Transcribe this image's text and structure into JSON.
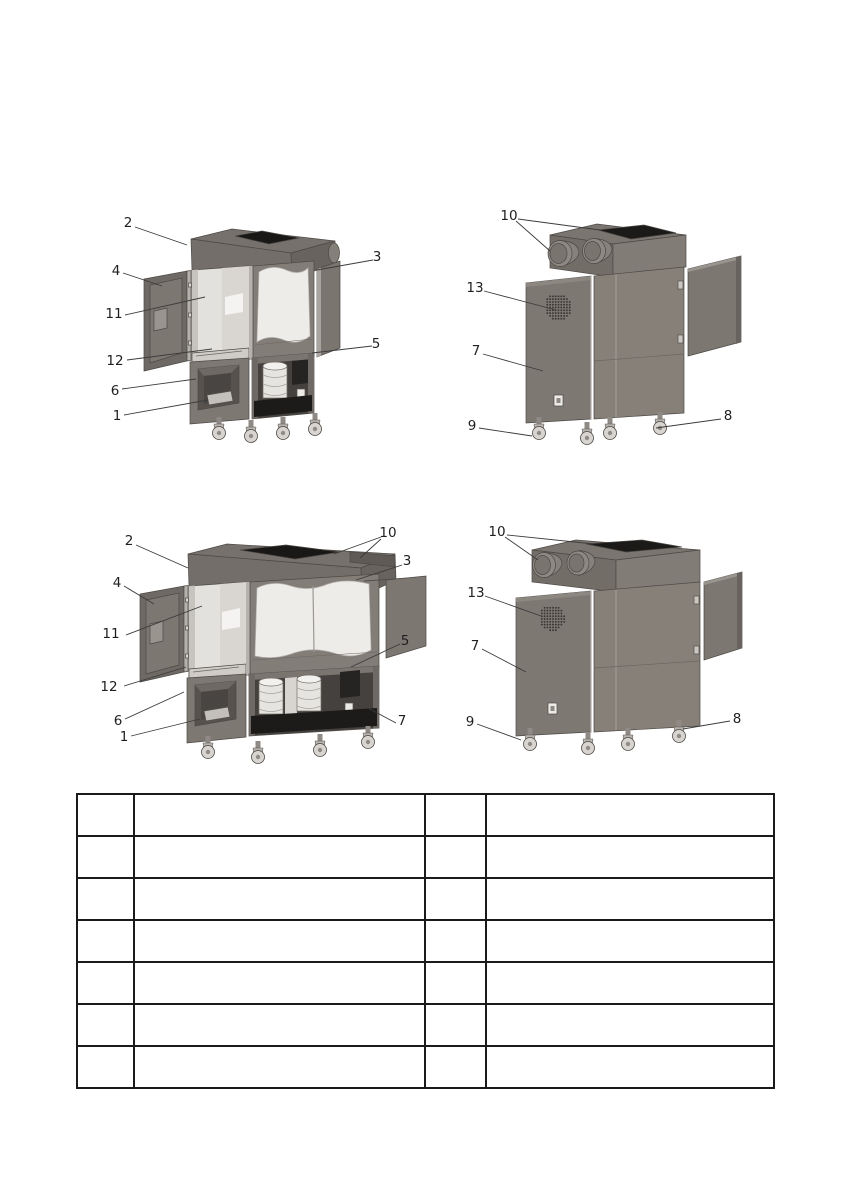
{
  "document": {
    "type": "technical-manual-parts-page",
    "description": "Parts identification page: four grayscale isometric views of a filter/extraction machine (narrow and wide models, front and rear) with numbered callouts, above an empty 7-row legend table"
  },
  "colors": {
    "page_background": "#ffffff",
    "machine_body_gray": "#7e7873",
    "machine_dark_gray": "#6b6561",
    "interior_light": "#e3e1dd",
    "window_white": "#eeece9",
    "opening_black": "#191817",
    "leader_line": "#3c3c3c",
    "callout_text": "#1f1f1f",
    "table_border": "#1a1a1a"
  },
  "figures": [
    {
      "id": "front-view-narrow",
      "callouts": [
        {
          "label": "2",
          "x": 36,
          "y": 30,
          "leaders": [
            [
              43,
              34,
              95,
              52
            ]
          ]
        },
        {
          "label": "4",
          "x": 24,
          "y": 78,
          "leaders": [
            [
              31,
              80,
              70,
              93
            ]
          ]
        },
        {
          "label": "11",
          "x": 22,
          "y": 121,
          "leaders": [
            [
              33,
              122,
              113,
              104
            ]
          ]
        },
        {
          "label": "12",
          "x": 23,
          "y": 168,
          "leaders": [
            [
              35,
              167,
              120,
              156
            ]
          ]
        },
        {
          "label": "6",
          "x": 23,
          "y": 198,
          "leaders": [
            [
              30,
              196,
              104,
              186
            ]
          ]
        },
        {
          "label": "1",
          "x": 25,
          "y": 223,
          "leaders": [
            [
              32,
              222,
              116,
              207
            ]
          ]
        },
        {
          "label": "3",
          "x": 285,
          "y": 64,
          "leaders": [
            [
              281,
              67,
              225,
              77
            ]
          ]
        },
        {
          "label": "5",
          "x": 284,
          "y": 151,
          "leaders": [
            [
              280,
              153,
              220,
              160
            ]
          ]
        }
      ]
    },
    {
      "id": "rear-view-narrow",
      "callouts": [
        {
          "label": "10",
          "x": 61,
          "y": 23,
          "leaders": [
            [
              68,
              28,
              102,
              58
            ],
            [
              70,
              26,
              152,
              37
            ]
          ]
        },
        {
          "label": "13",
          "x": 27,
          "y": 95,
          "leaders": [
            [
              36,
              98,
              108,
              117
            ]
          ]
        },
        {
          "label": "7",
          "x": 28,
          "y": 158,
          "leaders": [
            [
              35,
              161,
              95,
              178
            ]
          ]
        },
        {
          "label": "9",
          "x": 24,
          "y": 233,
          "leaders": [
            [
              31,
              235,
              84,
              243
            ]
          ]
        },
        {
          "label": "8",
          "x": 280,
          "y": 223,
          "leaders": [
            [
              273,
              226,
              208,
              235
            ]
          ]
        }
      ]
    },
    {
      "id": "front-view-wide",
      "callouts": [
        {
          "label": "2",
          "x": 41,
          "y": 31,
          "leaders": [
            [
              48,
              35,
              100,
              58
            ]
          ]
        },
        {
          "label": "4",
          "x": 29,
          "y": 73,
          "leaders": [
            [
              36,
              76,
              66,
              94
            ]
          ]
        },
        {
          "label": "11",
          "x": 23,
          "y": 124,
          "leaders": [
            [
              38,
              125,
              114,
              96
            ]
          ]
        },
        {
          "label": "12",
          "x": 21,
          "y": 177,
          "leaders": [
            [
              36,
              176,
              98,
              157
            ]
          ]
        },
        {
          "label": "6",
          "x": 30,
          "y": 211,
          "leaders": [
            [
              37,
              209,
              96,
              182
            ]
          ]
        },
        {
          "label": "1",
          "x": 36,
          "y": 227,
          "leaders": [
            [
              43,
              226,
              112,
              209
            ]
          ]
        },
        {
          "label": "10",
          "x": 300,
          "y": 23,
          "leaders": [
            [
              293,
              27,
              246,
              44
            ],
            [
              293,
              29,
              272,
              48
            ]
          ]
        },
        {
          "label": "3",
          "x": 319,
          "y": 51,
          "leaders": [
            [
              314,
              55,
              268,
              70
            ]
          ]
        },
        {
          "label": "5",
          "x": 317,
          "y": 131,
          "leaders": [
            [
              312,
              134,
              263,
              157
            ]
          ]
        },
        {
          "label": "7",
          "x": 314,
          "y": 211,
          "leaders": [
            [
              308,
              213,
              280,
              198
            ]
          ]
        }
      ]
    },
    {
      "id": "rear-view-wide",
      "callouts": [
        {
          "label": "10",
          "x": 49,
          "y": 22,
          "leaders": [
            [
              57,
              27,
              90,
              50
            ],
            [
              59,
              25,
              146,
              34
            ]
          ]
        },
        {
          "label": "13",
          "x": 28,
          "y": 83,
          "leaders": [
            [
              37,
              86,
              93,
              106
            ]
          ]
        },
        {
          "label": "7",
          "x": 27,
          "y": 136,
          "leaders": [
            [
              34,
              139,
              78,
              162
            ]
          ]
        },
        {
          "label": "9",
          "x": 22,
          "y": 212,
          "leaders": [
            [
              29,
              214,
              73,
              230
            ]
          ]
        },
        {
          "label": "8",
          "x": 289,
          "y": 209,
          "leaders": [
            [
              282,
              211,
              235,
              219
            ]
          ]
        }
      ]
    }
  ],
  "legend_table": {
    "columns": [
      "",
      "",
      "",
      ""
    ],
    "rows": [
      [
        "",
        "",
        "",
        ""
      ],
      [
        "",
        "",
        "",
        ""
      ],
      [
        "",
        "",
        "",
        ""
      ],
      [
        "",
        "",
        "",
        ""
      ],
      [
        "",
        "",
        "",
        ""
      ],
      [
        "",
        "",
        "",
        ""
      ],
      [
        "",
        "",
        "",
        ""
      ]
    ]
  }
}
